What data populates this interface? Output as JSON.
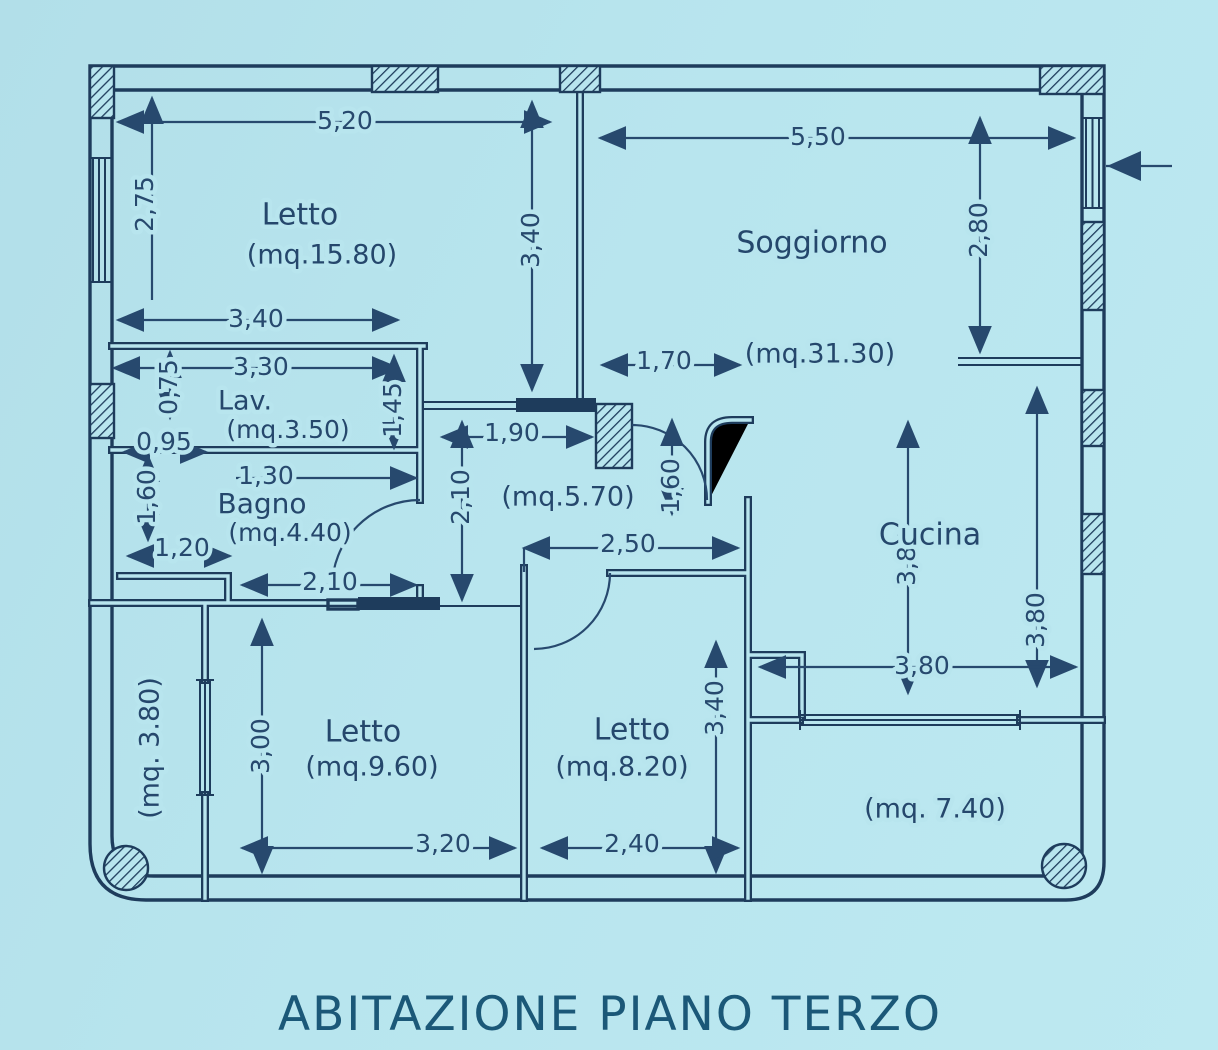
{
  "title": "ABITAZIONE PIANO TERZO",
  "colors": {
    "background": "#b8e5ee",
    "ink": "#1e3c5c",
    "text": "#27496e",
    "title": "#1b5878"
  },
  "plan": {
    "rooms": {
      "letto1": {
        "name": "Letto",
        "area": "(mq.15.80)"
      },
      "soggiorno": {
        "name": "Soggiorno",
        "area": "(mq.31.30)"
      },
      "lav": {
        "name": "Lav.",
        "area": "(mq.3.50)"
      },
      "bagno": {
        "name": "Bagno",
        "area": "(mq.4.40)"
      },
      "disimpegno": {
        "area": "(mq.5.70)"
      },
      "cucina": {
        "name": "Cucina"
      },
      "letto2": {
        "name": "Letto",
        "area": "(mq.9.60)"
      },
      "letto3": {
        "name": "Letto",
        "area": "(mq.8.20)"
      },
      "balcone_sx": {
        "area": "(mq. 3.80)"
      },
      "balcone_dx": {
        "area": "(mq. 7.40)"
      }
    },
    "dims": {
      "letto1_w": "5,20",
      "soggiorno_w": "5,50",
      "letto1_h": "2,75",
      "divider_h": "3,40",
      "letto1_s": "3,40",
      "lav_w": "3,30",
      "lav_h": "0,75",
      "nicchia_w": "0,95",
      "lav_r": "1,45",
      "bagno_w1": "1,30",
      "nicchia_h": "1,60",
      "bagno_w2": "1,20",
      "bagno_w3": "2,10",
      "corridoio_h": "2,10",
      "corridoio_w1": "1,90",
      "corridoio_w2": "1,70",
      "porta_h": "1,60",
      "corridoio_w3": "2,50",
      "ingresso_h": "2,80",
      "cucina_hc": "3,80",
      "cucina_hr": "3,80",
      "cucina_w": "3,80",
      "letto2_h": "3,00",
      "letto2_w": "3,20",
      "letto3_h": "3,40",
      "letto3_w": "2,40"
    }
  }
}
